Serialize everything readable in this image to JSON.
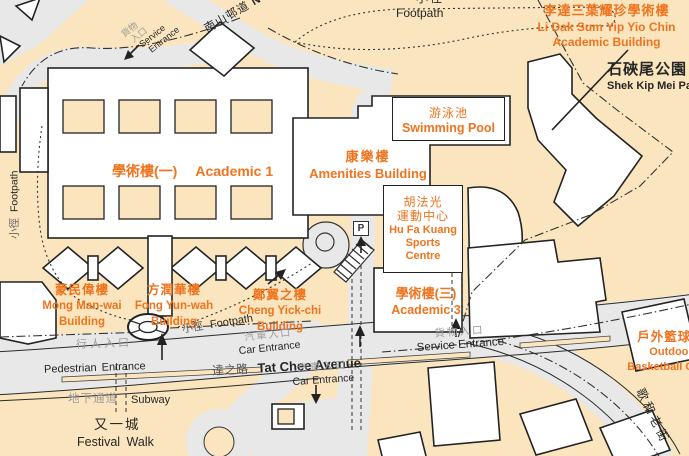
{
  "colors": {
    "campus_bg": "#FAE5BE",
    "road_fill": "#E8E8E8",
    "outline": "#2B2B2B",
    "accent_orange": "#F0731E",
    "grey_text": "#9C9C9C",
    "black_text": "#262626"
  },
  "labels": {
    "footpath_top": {
      "zh": "小徑",
      "en": "Footpath"
    },
    "nam_shan_chuen_road": {
      "zh": "南山邨道",
      "en": "N"
    },
    "service_entrance_nw": {
      "zh1": "貨物",
      "zh2": "入口",
      "en1": "Service",
      "en2": "Entrance"
    },
    "li_dak_sum_academic_building": {
      "zh": "李達三葉耀珍學術樓",
      "en1": "Li Dak Sum Yip Yio Chin",
      "en2": "Academic Building"
    },
    "shek_kip_mei_park": {
      "zh": "石硤尾公園",
      "en": "Shek Kip Mei Park"
    },
    "academic_1": {
      "zh": "學術樓(一)",
      "en": "Academic 1"
    },
    "swimming_pool": {
      "zh": "游泳池",
      "en": "Swimming Pool"
    },
    "amenities_building": {
      "zh": "康樂樓",
      "en": "Amenities Building"
    },
    "hu_fa_kuang_sports_centre": {
      "zh1": "胡法光",
      "zh2": "運動中心",
      "en1": "Hu Fa Kuang",
      "en2": "Sports",
      "en3": "Centre"
    },
    "mong_man_wai_building": {
      "zh": "蒙民偉樓",
      "en1": "Mong Man-wai",
      "en2": "Building"
    },
    "fong_yun_wah_building": {
      "zh": "方潤華樓",
      "en1": "Fong Yun-wah",
      "en2": "Building"
    },
    "cheng_yick_chi_building": {
      "zh": "鄭翼之樓",
      "en1": "Cheng Yick-chi",
      "en2": "Building"
    },
    "academic_3": {
      "zh": "學術樓(三)",
      "en": "Academic 3"
    },
    "outdoor_basketball_court": {
      "zh": "戶外籃球場",
      "en1": "Outdoor",
      "en2": "Basketball Court"
    },
    "footpath_left": {
      "zh": "小徑",
      "en": "Footpath"
    },
    "footpath_tat_chee": {
      "zh": "小徑",
      "en": "Footpath"
    },
    "pedestrian_entrance": {
      "zh": "行人入口",
      "en": "Pedestrian Entrance"
    },
    "tat_chee_avenue": {
      "zh": "達之路",
      "en": "Tat Chee Avenue"
    },
    "car_entrance_upper": {
      "zh": "汽車入口",
      "en": "Car Entrance"
    },
    "car_entrance_lower": {
      "zh": "汽車入口",
      "en": "Car Entrance"
    },
    "service_entrance_tat_chee": {
      "zh": "貨物入口",
      "en": "Service Entrance"
    },
    "subway": {
      "zh": "地下通道",
      "en": "Subway"
    },
    "festival_walk": {
      "zh": "又一城",
      "en": "Festival Walk"
    },
    "cornwall_street": {
      "zh": "歌和老街"
    },
    "parking_sign": {
      "letter": "P"
    }
  }
}
